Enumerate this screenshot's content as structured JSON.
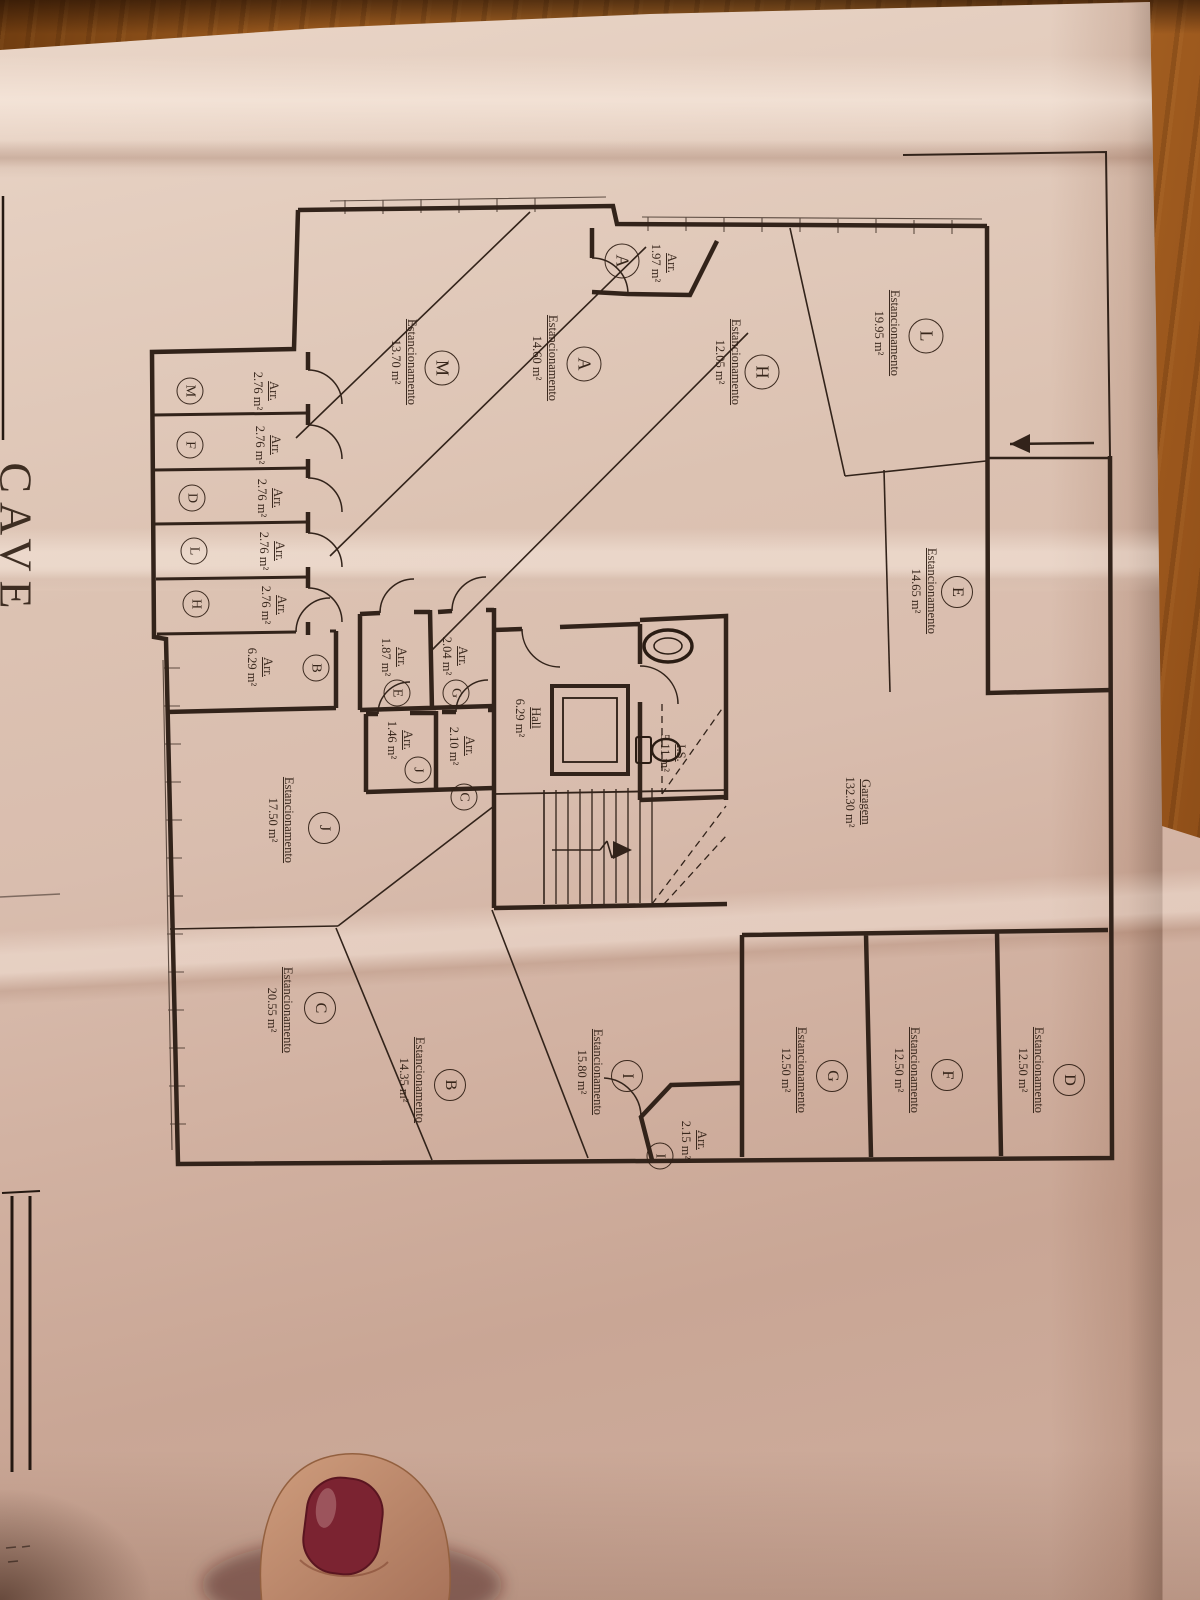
{
  "meta": {
    "floor_title": "CAVE"
  },
  "labels": {
    "parking": "Estancionamento",
    "storage": "Arr."
  },
  "rooms": {
    "garagem": {
      "name": "Garagem",
      "area": "132.30 m²"
    },
    "hall": {
      "name": "Hall",
      "area": "6.29 m²"
    },
    "wc": {
      "name": "I.S.",
      "area": "5.11 m²"
    }
  },
  "parking": [
    {
      "id": "L",
      "area": "19.95 m²"
    },
    {
      "id": "A",
      "area": "14.60 m²"
    },
    {
      "id": "H",
      "area": "12.05 m²"
    },
    {
      "id": "M",
      "area": "13.70 m²"
    },
    {
      "id": "E",
      "area": "14.65 m²"
    },
    {
      "id": "J",
      "area": "17.50 m²"
    },
    {
      "id": "C",
      "area": "20.55 m²"
    },
    {
      "id": "B",
      "area": "14.35 m²"
    },
    {
      "id": "I",
      "area": "15.80 m²"
    },
    {
      "id": "G",
      "area": "12.50 m²"
    },
    {
      "id": "F",
      "area": "12.50 m²"
    },
    {
      "id": "D",
      "area": "12.50 m²"
    }
  ],
  "storage": [
    {
      "id": "A",
      "area": "1.97 m²"
    },
    {
      "id": "M",
      "area": "2.76 m²"
    },
    {
      "id": "F",
      "area": "2.76 m²"
    },
    {
      "id": "D",
      "area": "2.76 m²"
    },
    {
      "id": "L",
      "area": "2.76 m²"
    },
    {
      "id": "H",
      "area": "2.76 m²"
    },
    {
      "id": "B",
      "area": "6.29 m²"
    },
    {
      "id": "E",
      "area": "1.87 m²"
    },
    {
      "id": "G",
      "area": "2.04 m²"
    },
    {
      "id": "J",
      "area": "1.46 m²"
    },
    {
      "id": "C",
      "area": "2.10 m²"
    },
    {
      "id": "I",
      "area": "2.15 m²"
    }
  ]
}
